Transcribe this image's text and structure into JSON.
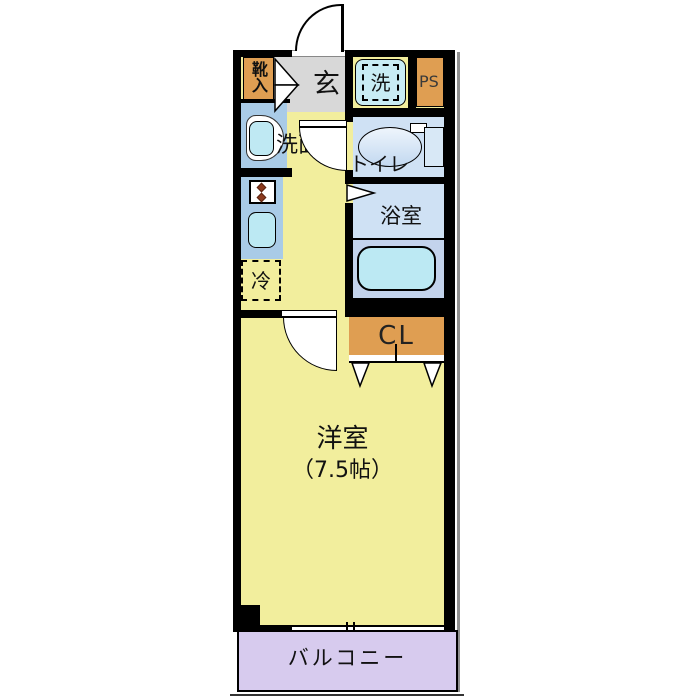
{
  "plan": {
    "rooms": {
      "genkan": {
        "label": "玄"
      },
      "shoe_box": {
        "label": "靴入"
      },
      "washer": {
        "label": "洗"
      },
      "pipe_space": {
        "label": "PS"
      },
      "washroom": {
        "label": "洗面"
      },
      "toilet": {
        "label": "トイレ"
      },
      "bathroom": {
        "label": "浴室"
      },
      "refrigerator": {
        "label": "冷"
      },
      "closet": {
        "label": "CL"
      },
      "western_room": {
        "label": "洋室",
        "size": "（7.5帖）"
      },
      "balcony": {
        "label": "バルコニー"
      }
    },
    "colors": {
      "wall": "#000000",
      "floor_yellow": "#f2ee9d",
      "genkan_gray": "#d8d8d8",
      "storage_orange": "#df9e52",
      "wet_room_blue": "#cfe1f4",
      "tub_zone_blue": "#c3d3ec",
      "fixture_cyan": "#bfe9f3",
      "counter_blue": "#a9cbe7",
      "balcony_purple": "#d7cbee",
      "burner_brown": "#8c3a1d"
    },
    "symbols": {
      "entrance_door": "door-swing-arc",
      "room_door": "door-swing-quarter-sector",
      "toilet_door": "door-swing-quarter-sector",
      "bath_door": "folding-door-triangle",
      "shoe_box_doors": "double-door-triangles",
      "closet_doors": "double-door-triangles",
      "window": "sliding-window-band",
      "refrigerator_space": "dashed-outline",
      "washer_space": "dashed-outline"
    }
  }
}
